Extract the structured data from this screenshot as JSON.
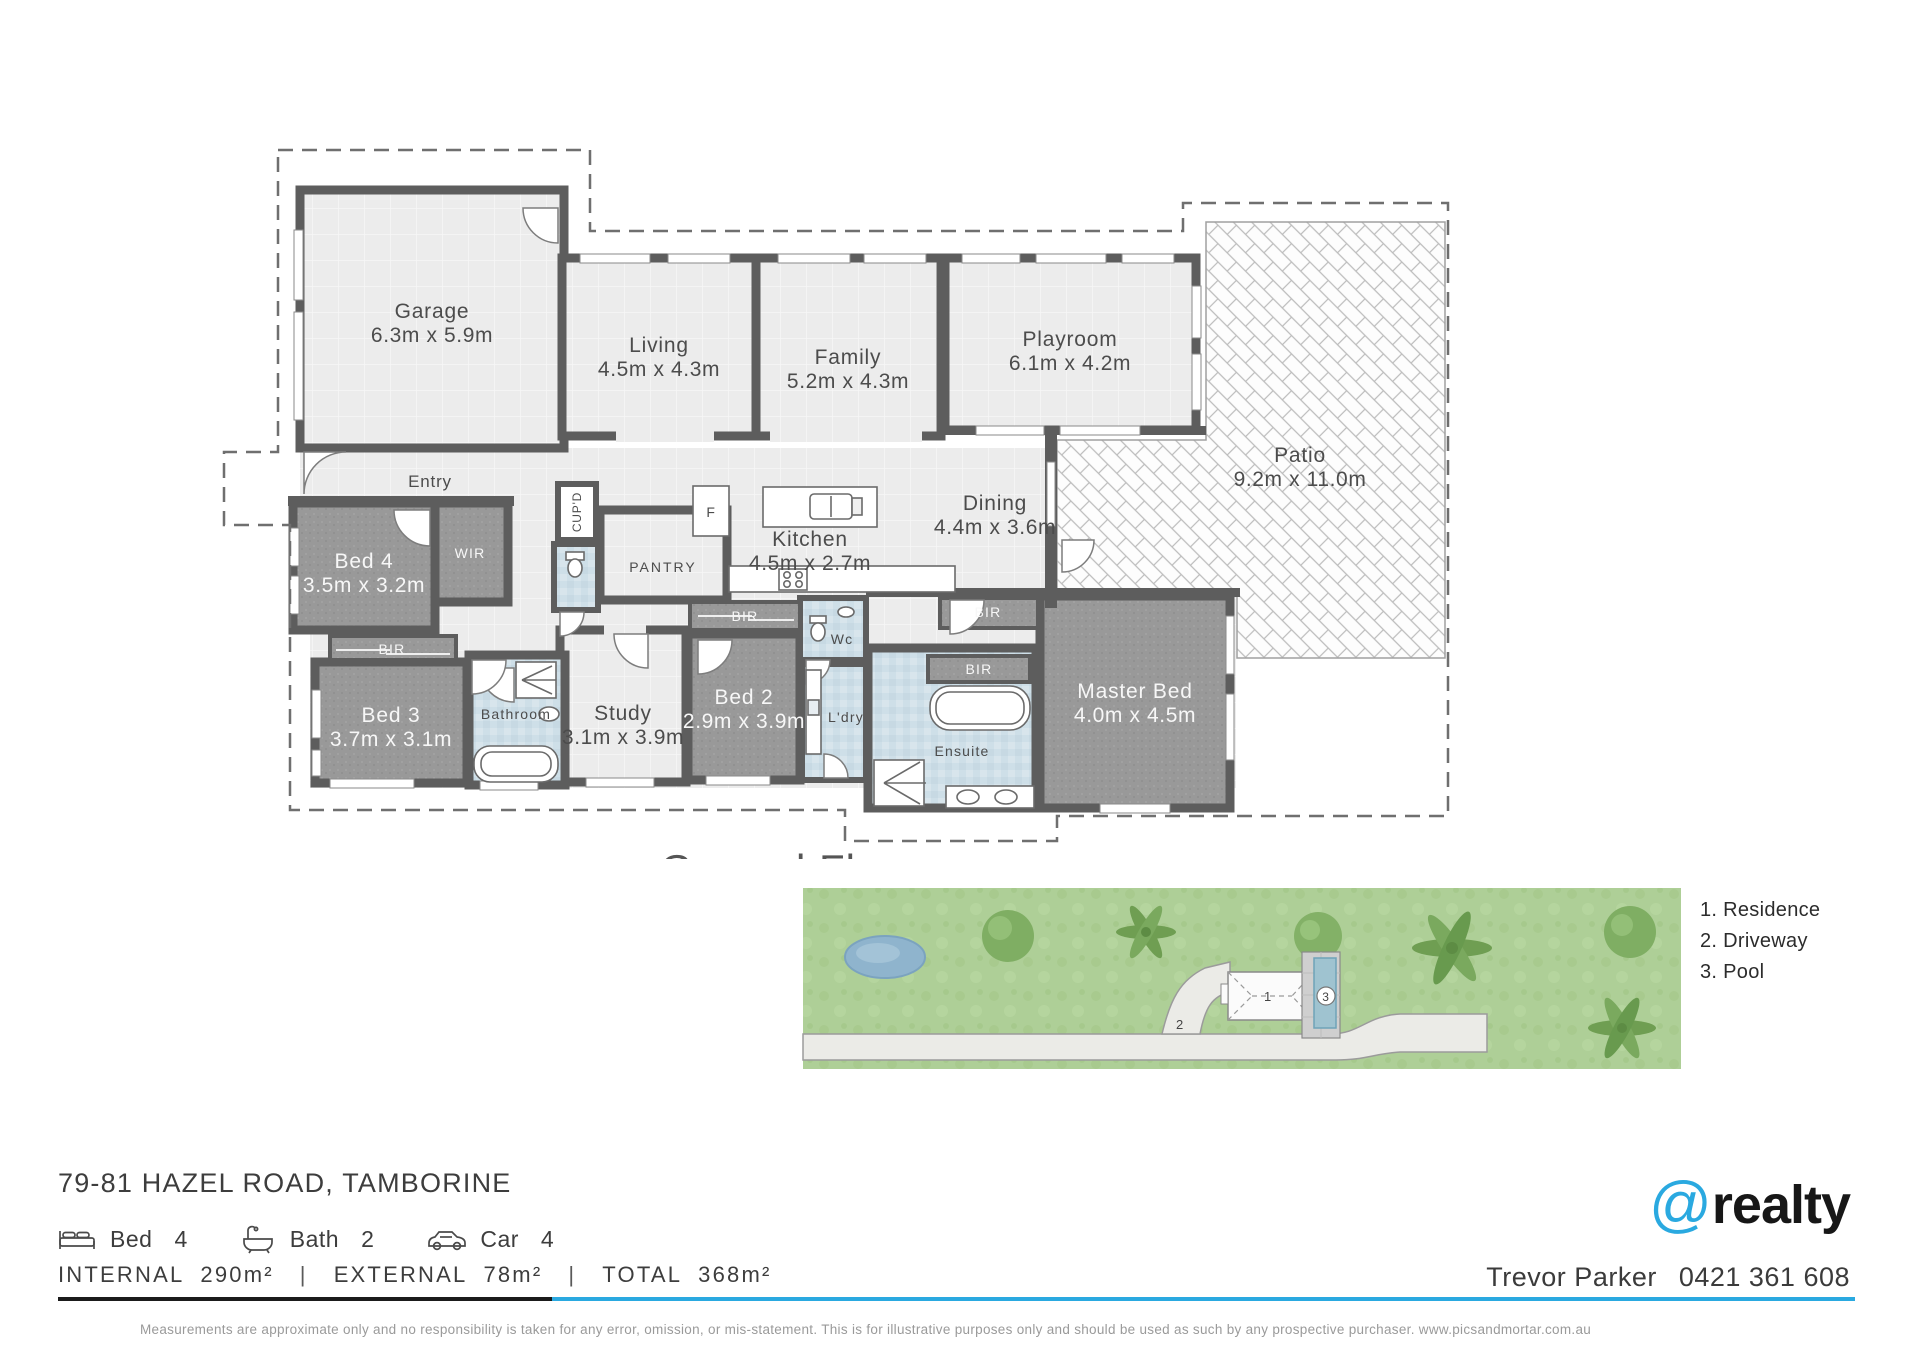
{
  "floorplan": {
    "rooms": {
      "garage": {
        "name": "Garage",
        "dims": "6.3m x 5.9m"
      },
      "living": {
        "name": "Living",
        "dims": "4.5m x 4.3m"
      },
      "family": {
        "name": "Family",
        "dims": "5.2m x 4.3m"
      },
      "playroom": {
        "name": "Playroom",
        "dims": "6.1m x 4.2m"
      },
      "patio": {
        "name": "Patio",
        "dims": "9.2m x 11.0m"
      },
      "dining": {
        "name": "Dining",
        "dims": "4.4m x 3.6m"
      },
      "kitchen": {
        "name": "Kitchen",
        "dims": "4.5m x 2.7m"
      },
      "master": {
        "name": "Master Bed",
        "dims": "4.0m x 4.5m"
      },
      "bed2": {
        "name": "Bed 2",
        "dims": "2.9m x 3.9m"
      },
      "bed3": {
        "name": "Bed 3",
        "dims": "3.7m x 3.1m"
      },
      "bed4": {
        "name": "Bed 4",
        "dims": "3.5m x 3.2m"
      },
      "study": {
        "name": "Study",
        "dims": "3.1m x 3.9m"
      },
      "entry": "Entry",
      "wir": "WIR",
      "bir": "BIR",
      "bathroom": "Bathroom",
      "ensuite": "Ensuite",
      "ldry": "L'dry",
      "wc": "Wc",
      "pantry": "PANTRY",
      "cupd": "CUP'D",
      "fridge": "F"
    },
    "partial_text": "Ground Floor"
  },
  "siteplan": {
    "legend": [
      "1. Residence",
      "2. Driveway",
      "3. Pool"
    ],
    "markers": {
      "residence": "1",
      "driveway": "2",
      "pool": "3"
    }
  },
  "footer": {
    "address": "79-81 HAZEL ROAD, TAMBORINE",
    "features": [
      {
        "icon": "bed-icon",
        "label": "Bed",
        "value": "4"
      },
      {
        "icon": "bath-icon",
        "label": "Bath",
        "value": "2"
      },
      {
        "icon": "car-icon",
        "label": "Car",
        "value": "4"
      }
    ],
    "areas": {
      "internal_label": "INTERNAL",
      "internal_value": "290m²",
      "external_label": "EXTERNAL",
      "external_value": "78m²",
      "total_label": "TOTAL",
      "total_value": "368m²",
      "separator": "|"
    },
    "agent": {
      "name": "Trevor Parker",
      "phone": "0421 361 608"
    },
    "brand": {
      "at": "@",
      "name": "realty"
    },
    "disclaimer": "Measurements are approximate only and no responsibility is taken for any error, omission, or mis-statement. This is for illustrative purposes only and should be used as such by any prospective purchaser. www.picsandmortar.com.au",
    "colors": {
      "accent_blue": "#2aa9e0"
    }
  }
}
